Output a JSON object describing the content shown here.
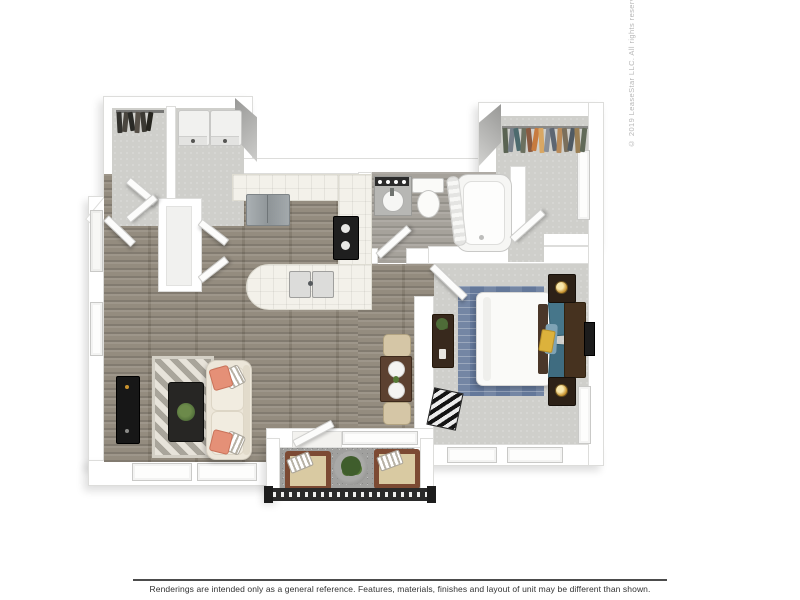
{
  "footer": {
    "disclaimer": "Renderings are intended only as a general reference. Features, materials, finishes and layout of unit may be different than shown."
  },
  "watermark": {
    "copyright": "© 2019 LeaseStar LLC. All rights reserved"
  },
  "palette": {
    "background": "#ffffff",
    "wall": "#ffffff",
    "wall_edge": "#dddddb",
    "wood_floor": "#8e8678",
    "carpet": "#cfcfcb",
    "bath_floor": "#a6a29b",
    "patio_floor": "#a0a09e",
    "counter_tile": "#f3f1ea",
    "sofa": "#ece6d9",
    "coral_pillow": "#e59077",
    "bedroom_rug": "#64789a",
    "teal_pillow": "#46768a",
    "gold_accent": "#dcb23c",
    "headboard": "#46321f",
    "nightstand": "#2d2117",
    "stove": "#1f1f1f",
    "refrigerator": "#9ba1a4",
    "railing": "#2a2a2a",
    "plant_green": "#4e6c38",
    "dining_table": "#5c4130",
    "tan_chair": "#d5c6a6",
    "divider_line": "#4c4c4c",
    "footer_text": "#333333",
    "copyright_text": "#b7b7b7"
  },
  "closet_clothes": {
    "walk_in": [
      "#5a6352",
      "#77808a",
      "#4d6b6e",
      "#6b705f",
      "#8a5a40",
      "#c77b3f",
      "#d9a763",
      "#8a8f98",
      "#5d6672",
      "#b98b5a",
      "#7a6f5c",
      "#4f5a63",
      "#9a7f55",
      "#616a58"
    ],
    "entry": [
      "#33322e",
      "#4a463f",
      "#2a2a26",
      "#565048",
      "#3c3a34",
      "#26251f"
    ]
  },
  "inventory": {
    "rooms": [
      "living-room",
      "kitchen",
      "dining-area",
      "bathroom",
      "bedroom",
      "walk-in-closet",
      "entry-closet",
      "laundry-closet",
      "balcony"
    ],
    "furniture": [
      "sofa",
      "living-room-rug",
      "coffee-table",
      "tv-console",
      "dining-table",
      "dining-chairs",
      "refrigerator",
      "stove",
      "kitchen-sink",
      "vanity-sink",
      "toilet",
      "bathtub",
      "bed",
      "headboard",
      "nightstands",
      "table-lamps",
      "dresser",
      "bedroom-rug",
      "washer-dryer",
      "clothes-racks",
      "patio-chairs",
      "patio-plant",
      "balcony-railing"
    ]
  }
}
